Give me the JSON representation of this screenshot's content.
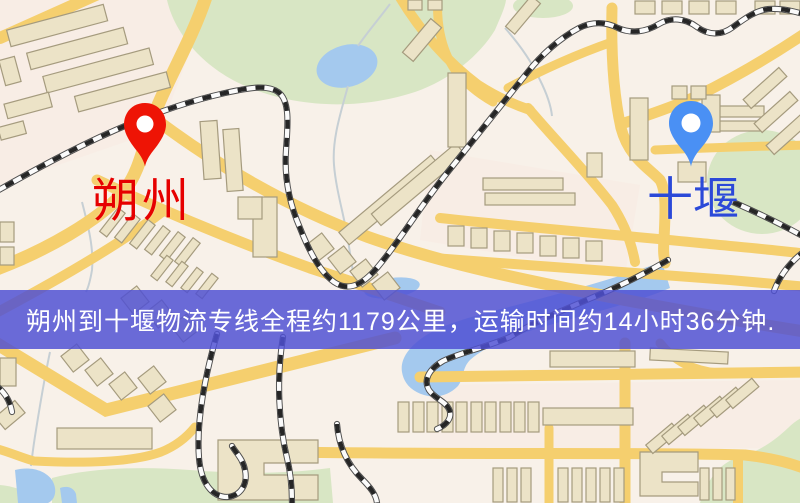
{
  "banner": {
    "text": "朔州到十堰物流专线全程约1179公里，运输时间约14小时36分钟.",
    "background_color": "#4f50d3",
    "text_color": "#ffffff"
  },
  "map": {
    "origin_marker": {
      "name": "朔州",
      "pin_color": "#ee1405",
      "label_color": "#e60000"
    },
    "destination_marker": {
      "name": "十堰",
      "pin_color": "#4a90f4",
      "label_color": "#2b49d8"
    },
    "palette": {
      "road": "#f5cf6e",
      "building": "#ece3c7",
      "park": "#d8e6c4",
      "water": "#a4c9ee",
      "background": "#f8f1e9",
      "railway_dash": "#262626"
    }
  }
}
